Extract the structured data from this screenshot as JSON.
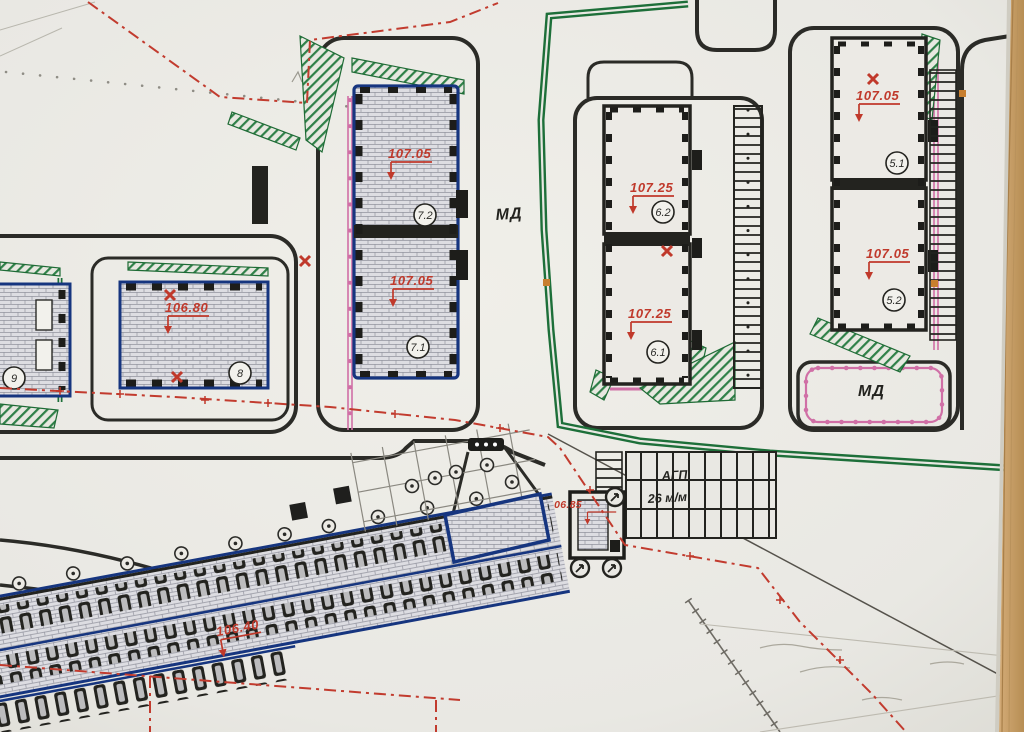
{
  "plan": {
    "street_label": "МД",
    "block_label": "МД",
    "parking": {
      "title": "АГП",
      "capacity": "26 м/м"
    },
    "buildings": {
      "b7": {
        "upper": {
          "unit": "7.2",
          "elevation": "107.05"
        },
        "lower": {
          "unit": "7.1",
          "elevation": "107.05"
        }
      },
      "b6": {
        "upper": {
          "unit": "6.2",
          "elevation": "107.25"
        },
        "lower": {
          "unit": "6.1",
          "elevation": "107.25"
        }
      },
      "b5": {
        "upper": {
          "unit": "5.1",
          "elevation": "107.05"
        },
        "lower": {
          "unit": "5.2",
          "elevation": "107.05"
        }
      },
      "b8": {
        "unit": "8",
        "elevation": "106.80"
      },
      "b9": {
        "unit": "9"
      },
      "kiosk": {
        "elevation": "106.85"
      },
      "garage": {
        "elevation": "106.40"
      }
    },
    "colors": {
      "annotation_red": "#c0392b",
      "boundary_green": "#1d6f39",
      "outline_blue": "#16357f",
      "utility_pink": "#d06fa6",
      "ink_black": "#23231f",
      "paper": "#eae9e4",
      "wood_table": "#c9a06a"
    }
  }
}
